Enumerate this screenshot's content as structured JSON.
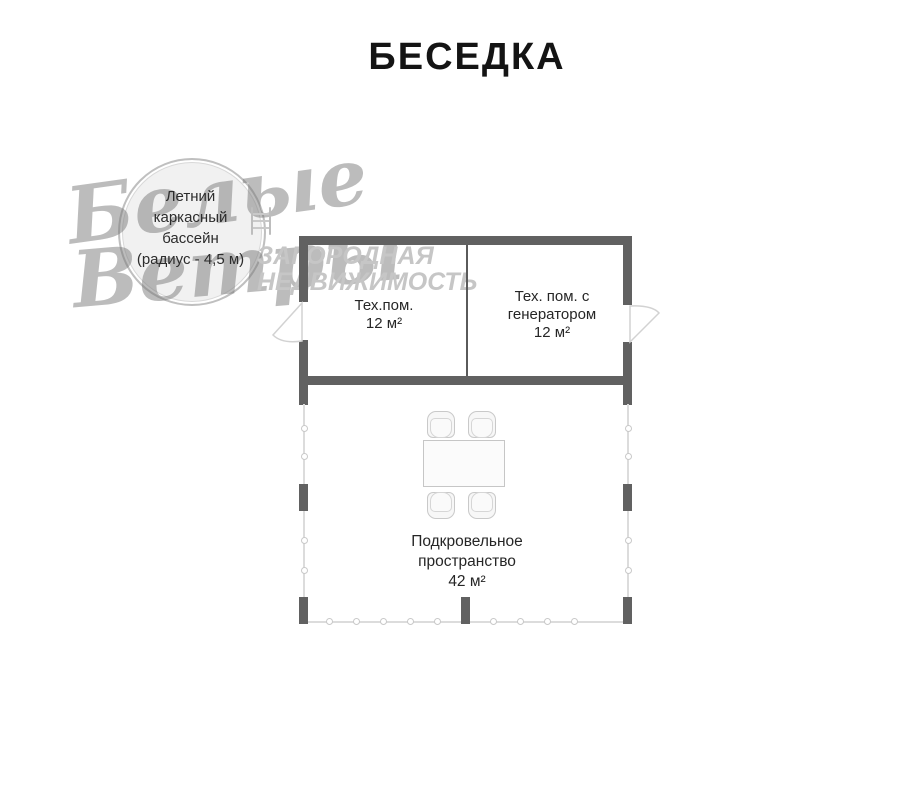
{
  "title": "БЕСЕДКА",
  "watermark": {
    "script_top": "Белые",
    "script_bottom": "Ветры",
    "caption_line1": "ЗАГОРОДНАЯ",
    "caption_line2": "НЕДВИЖИМОСТЬ"
  },
  "pool": {
    "lines": [
      "Летний",
      "каркасный",
      "бассейн",
      "(радиус - 4,5 м)"
    ]
  },
  "rooms": {
    "tech": {
      "lines": [
        "Тех.пом.",
        "12 м²"
      ]
    },
    "tech_generator": {
      "lines": [
        "Тех. пом. с",
        "генератором",
        "12 м²"
      ]
    },
    "under_roof": {
      "lines": [
        "Подкровельное",
        "пространство",
        "42 м²"
      ]
    }
  },
  "colors": {
    "wall": "#616161",
    "railing": "#dcdcdc",
    "text": "#262626",
    "watermark_script": "#7a7a7a",
    "watermark_caption": "#c6c6c6"
  }
}
